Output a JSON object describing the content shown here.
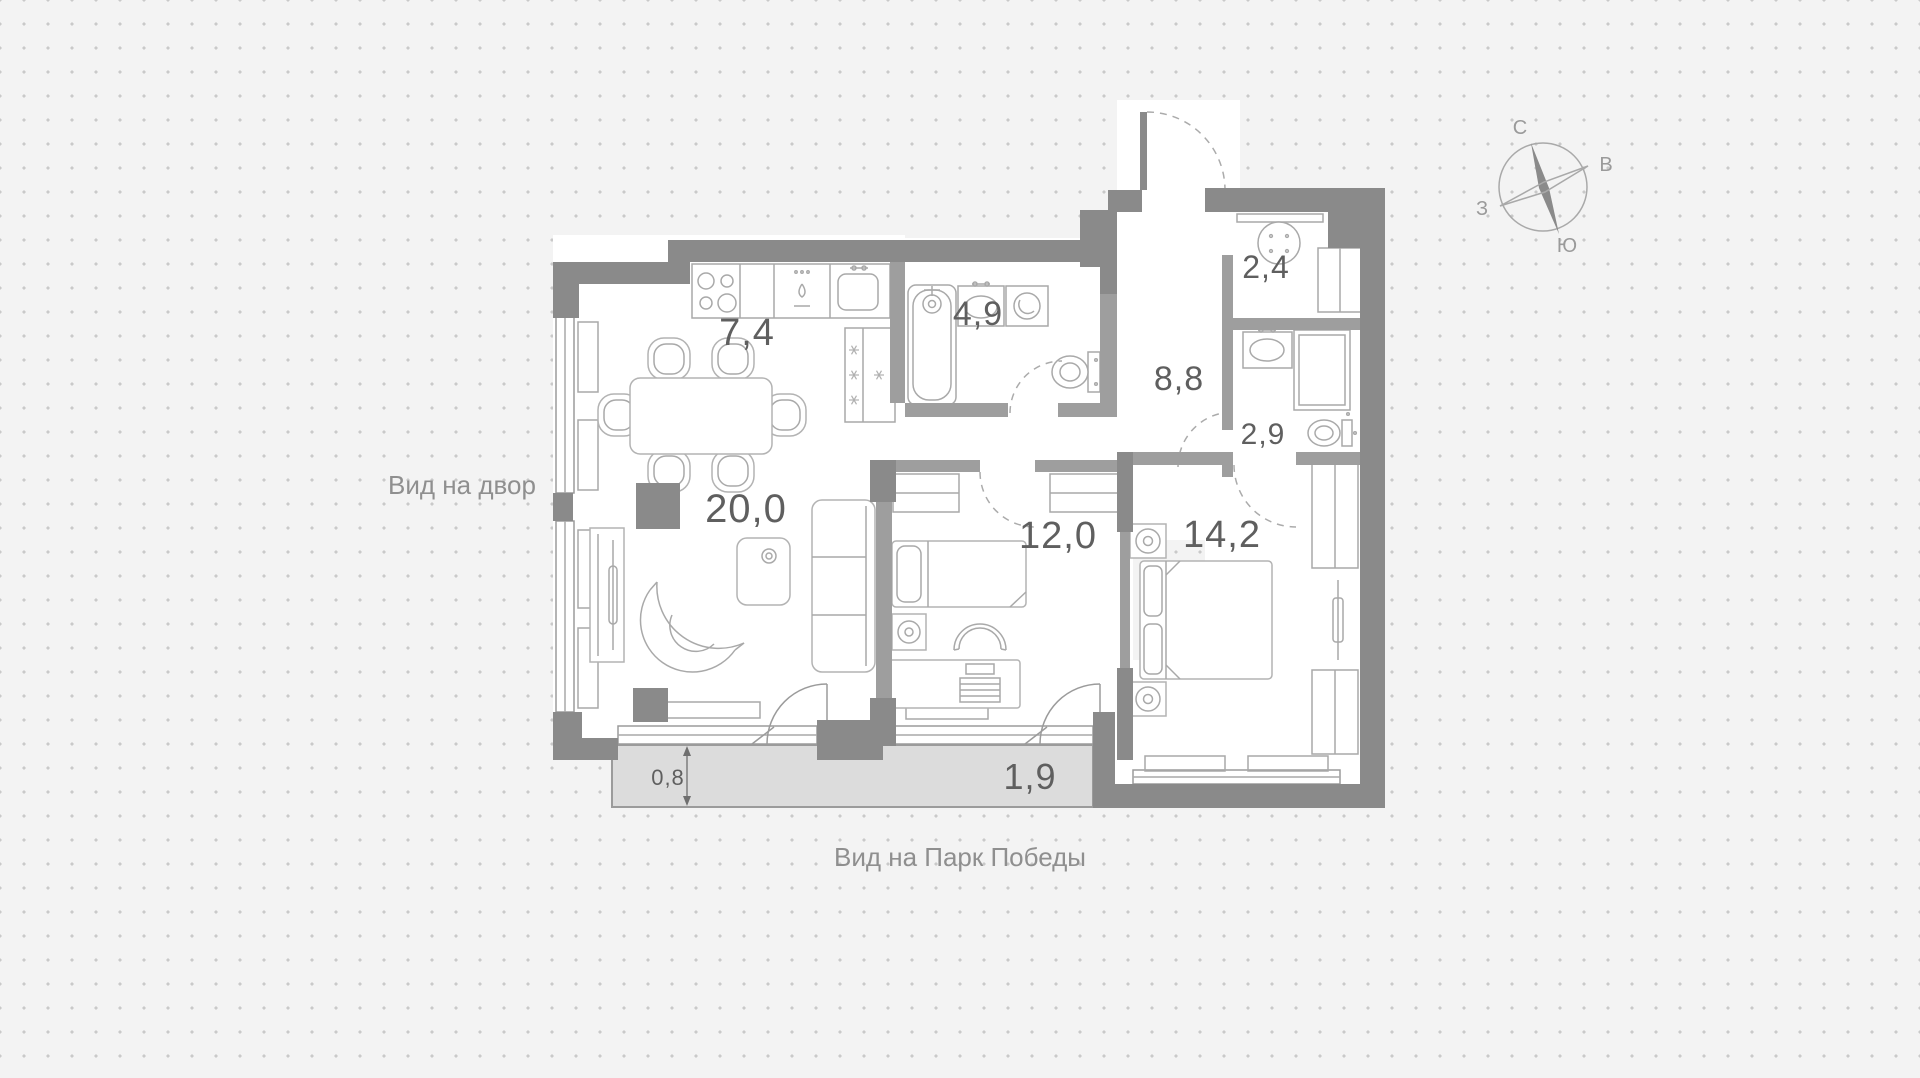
{
  "rooms": {
    "kitchen": {
      "area": "7,4"
    },
    "bathroom_main": {
      "area": "4,9"
    },
    "wardrobe_room": {
      "area": "2,4"
    },
    "hallway": {
      "area": "8,8"
    },
    "bathroom_guest": {
      "area": "2,9"
    },
    "living_room": {
      "area": "20,0"
    },
    "bedroom_child": {
      "area": "12,0"
    },
    "bedroom_master": {
      "area": "14,2"
    },
    "balcony": {
      "area": "1,9"
    }
  },
  "dimensions": {
    "balcony_depth": "0,8"
  },
  "views": {
    "left": "Вид на двор",
    "bottom": "Вид на Парк Победы"
  },
  "compass": {
    "north": "С",
    "east": "В",
    "south": "Ю",
    "west": "З"
  },
  "colors": {
    "background": "#f3f3f3",
    "dot": "#c9c9c9",
    "wall": "#8a8a8a",
    "wall_light": "#9e9e9e",
    "furniture_line": "#b3b3b3",
    "balcony_fill": "#dcdcdc",
    "label_text": "#5f5f5f",
    "view_text": "#8f8f8f"
  }
}
